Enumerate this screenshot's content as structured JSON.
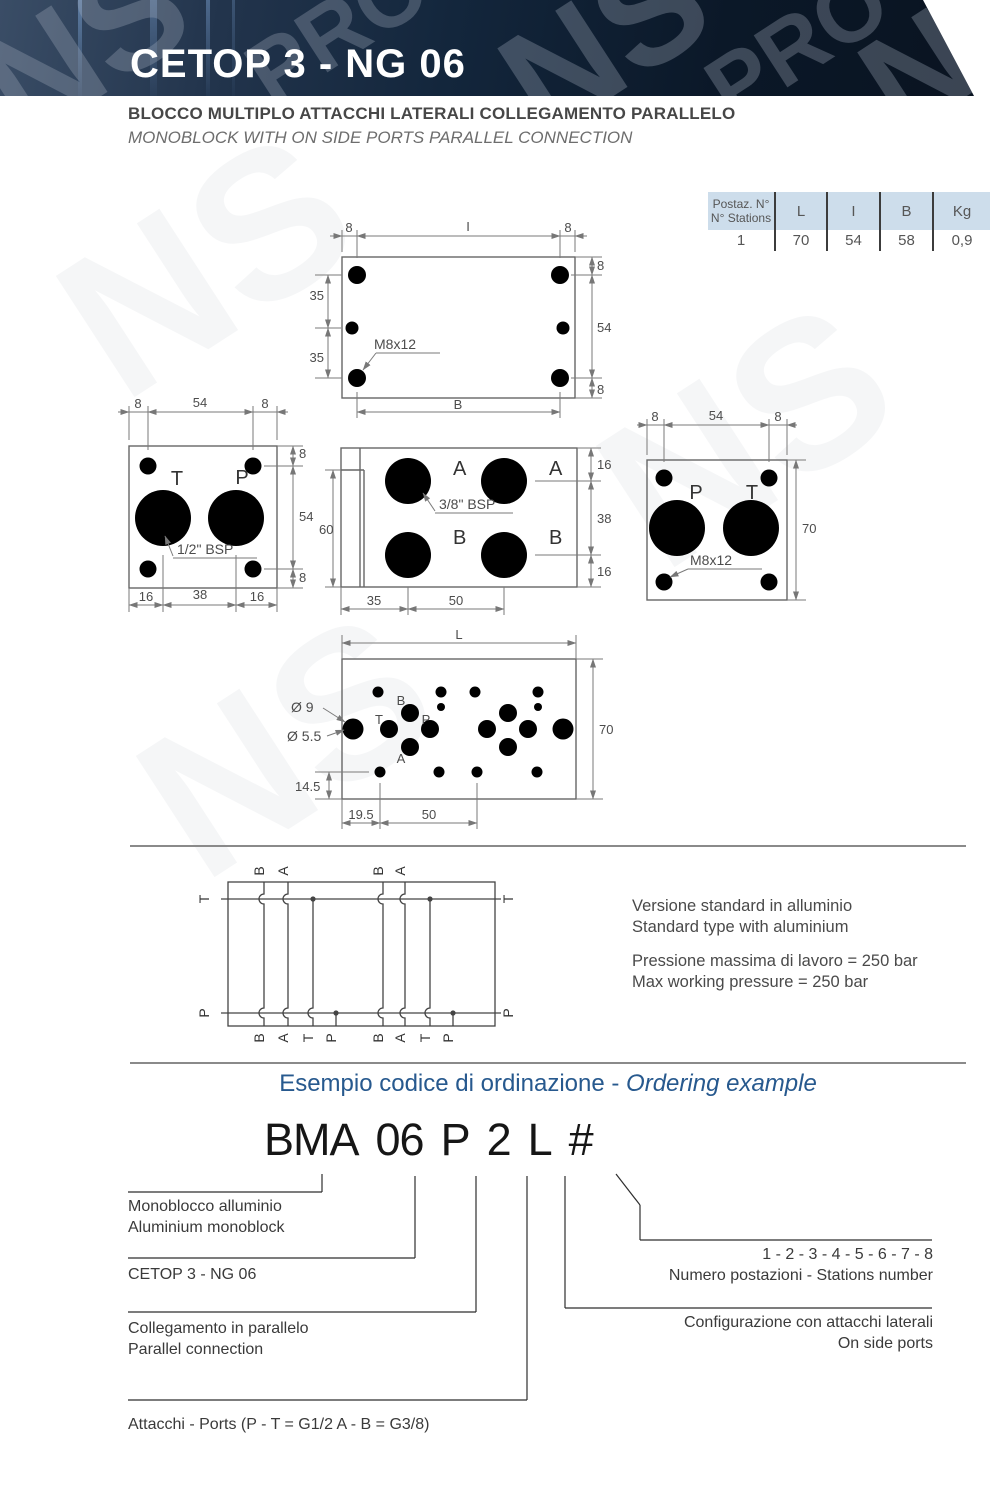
{
  "banner": {
    "title": "CETOP 3 - NG 06",
    "watermark_ns": "NS",
    "watermark_pro": "PRO"
  },
  "subtitle": {
    "line1": "BLOCCO MULTIPLO ATTACCHI LATERALI COLLEGAMENTO PARALLELO",
    "line2": "MONOBLOCK WITH ON SIDE PORTS PARALLEL CONNECTION"
  },
  "table": {
    "header": {
      "col0a": "Postaz. N°",
      "col0b": "N° Stations",
      "col1": "L",
      "col2": "I",
      "col3": "B",
      "col4": "Kg"
    },
    "rows": [
      [
        "1",
        "70",
        "54",
        "58",
        "0,9"
      ],
      [
        "2",
        "120",
        "104",
        "108",
        "1,5"
      ],
      [
        "3",
        "170",
        "154",
        "158",
        "2,2"
      ],
      [
        "4",
        "220",
        "204",
        "208",
        "2,8"
      ],
      [
        "5",
        "270",
        "254",
        "258",
        "3,5"
      ],
      [
        "6",
        "320",
        "304",
        "308",
        "4,2"
      ],
      [
        "7",
        "370",
        "354",
        "358",
        "4,8"
      ],
      [
        "8",
        "420",
        "404",
        "408",
        "5,5"
      ]
    ]
  },
  "drawings": {
    "top_view": {
      "d8a": "8",
      "dI": "I",
      "d8b": "8",
      "d8c": "8",
      "d54": "54",
      "d8d": "8",
      "d35a": "35",
      "d35b": "35",
      "dB": "B",
      "thread": "M8x12"
    },
    "left_view": {
      "d8a": "8",
      "d54a": "54",
      "d8b": "8",
      "d8c": "8",
      "d54b": "54",
      "d8d": "8",
      "d16a": "16",
      "d38": "38",
      "d16b": "16",
      "pT": "T",
      "pP": "P",
      "bsp": "1/2\" BSP"
    },
    "front_view": {
      "d60": "60",
      "d16a": "16",
      "d38": "38",
      "d16b": "16",
      "d35": "35",
      "d50": "50",
      "pA1": "A",
      "pA2": "A",
      "pB1": "B",
      "pB2": "B",
      "bsp": "3/8\" BSP"
    },
    "right_view": {
      "d8a": "8",
      "d54": "54",
      "d8b": "8",
      "d70": "70",
      "pP": "P",
      "pT": "T",
      "thread": "M8x12"
    },
    "pattern_view": {
      "dL": "L",
      "d70": "70",
      "dia9": "Ø 9",
      "dia55": "Ø 5.5",
      "d145": "14.5",
      "d195": "19.5",
      "d50": "50",
      "pB": "B",
      "pT": "T",
      "pP": "P",
      "pA": "A"
    },
    "schematic": {
      "tl": "T",
      "tr": "T",
      "pl": "P",
      "pr": "P",
      "top": [
        "B",
        "A",
        "B",
        "A"
      ],
      "bottom": [
        "B",
        "A",
        "T",
        "P",
        "B",
        "A",
        "T",
        "P"
      ]
    }
  },
  "notes": {
    "l1": "Versione standard in alluminio",
    "l2": "Standard type with aluminium",
    "l3": "Pressione massima di lavoro = 250 bar",
    "l4": "Max working pressure = 250 bar"
  },
  "ordering": {
    "heading_normal": "Esempio codice di ordinazione - ",
    "heading_italic": "Ordering example",
    "code": {
      "p1": "BMA",
      "p2": "06",
      "p3": "P",
      "p4": "2",
      "p5": "L",
      "p6": "#"
    },
    "legend": {
      "monoblock1": "Monoblocco alluminio",
      "monoblock2": "Aluminium monoblock",
      "cetop": "CETOP 3 - NG 06",
      "parallel1": "Collegamento in parallelo",
      "parallel2": "Parallel connection",
      "ports": "Attacchi - Ports (P - T = G1/2   A - B = G3/8)",
      "stations1": "1 - 2 - 3 - 4 - 5 - 6 - 7 - 8",
      "stations2": "Numero postazioni - Stations number",
      "config1": "Configurazione con attacchi laterali",
      "config2": "On side ports"
    }
  },
  "colors": {
    "accent_blue": "#27598e",
    "banner_dark": "#0b1828",
    "table_header": "#cdddeb",
    "stripe": "#e2e2e2"
  }
}
